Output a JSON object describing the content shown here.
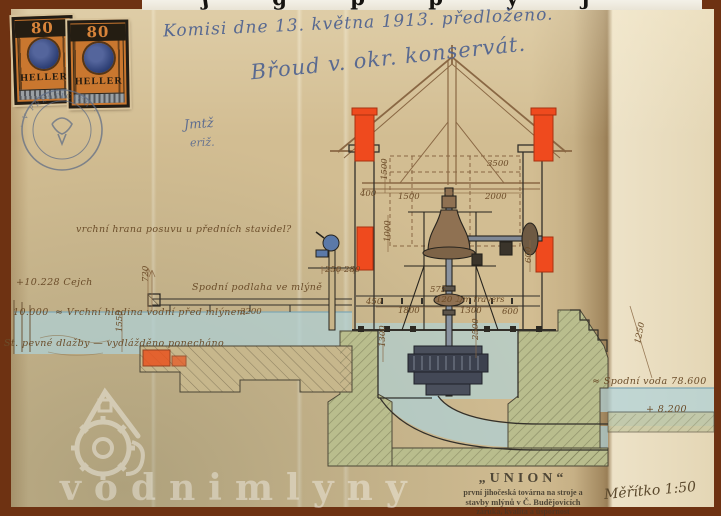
{
  "photo": {
    "top_edge_fragments": "ʃ g p p y ƒ"
  },
  "stamps": {
    "value": "80",
    "currency": "HELLER",
    "postmark_text": "· V PŘEŠTICÍCH ·"
  },
  "handwriting": {
    "commission_note": "Komisi dne 13. května 1913. předloženo.",
    "signature": "Břoud v. okr. konservát.",
    "initials_1": "Jmtž",
    "initials_2": "eriž."
  },
  "drawing": {
    "labels": {
      "gauge": "+10.228 Cejch",
      "headwater_value": "10.000",
      "headwater": "≈ Vrchní hladina vodní před mlýnem",
      "top_edge_note": "vrchní hrana posuvu u předních stavidel?",
      "floor": "Spodní podlaha ve mlýně",
      "pavement": "St. pevné dlažby — vydlážděno ponecháno",
      "tailwater": "≈ Spodní voda 78.600",
      "tailwater_elevation": "+ 8.200"
    },
    "dimensions": [
      {
        "t": "3500",
        "x": 487,
        "y": 166
      },
      {
        "t": "1500",
        "x": 398,
        "y": 199
      },
      {
        "t": "2000",
        "x": 485,
        "y": 199
      },
      {
        "t": "1500",
        "x": 387,
        "y": 180,
        "r": -90
      },
      {
        "t": "400",
        "x": 360,
        "y": 196
      },
      {
        "t": "575",
        "x": 430,
        "y": 292
      },
      {
        "t": "120 ⌶/m travers",
        "x": 436,
        "y": 302
      },
      {
        "t": "1800",
        "x": 398,
        "y": 313
      },
      {
        "t": "1300",
        "x": 460,
        "y": 313
      },
      {
        "t": "600",
        "x": 502,
        "y": 314
      },
      {
        "t": "1300",
        "x": 385,
        "y": 347,
        "r": -90
      },
      {
        "t": "2500",
        "x": 478,
        "y": 340,
        "r": -90
      },
      {
        "t": "1550",
        "x": 122,
        "y": 332,
        "r": -90
      },
      {
        "t": "720",
        "x": 148,
        "y": 282,
        "r": -90
      },
      {
        "t": "3200",
        "x": 240,
        "y": 314
      },
      {
        "t": "250",
        "x": 325,
        "y": 272
      },
      {
        "t": "280",
        "x": 344,
        "y": 272
      },
      {
        "t": "1000",
        "x": 390,
        "y": 242,
        "r": -90
      },
      {
        "t": "450",
        "x": 366,
        "y": 304
      },
      {
        "t": "600",
        "x": 531,
        "y": 263,
        "r": -90
      },
      {
        "t": "1250",
        "x": 640,
        "y": 344,
        "r": -78
      }
    ]
  },
  "union_stamp": {
    "line1": "„UNION“",
    "line2": "první jihočeská továrna na stroje a",
    "line3": "stavby mlýnů v Č. Budějovicích",
    "line4": "záruka, kvalita a úspornost"
  },
  "scale_note": "Měřítko 1:50",
  "watermark": "vodnimlyny"
}
